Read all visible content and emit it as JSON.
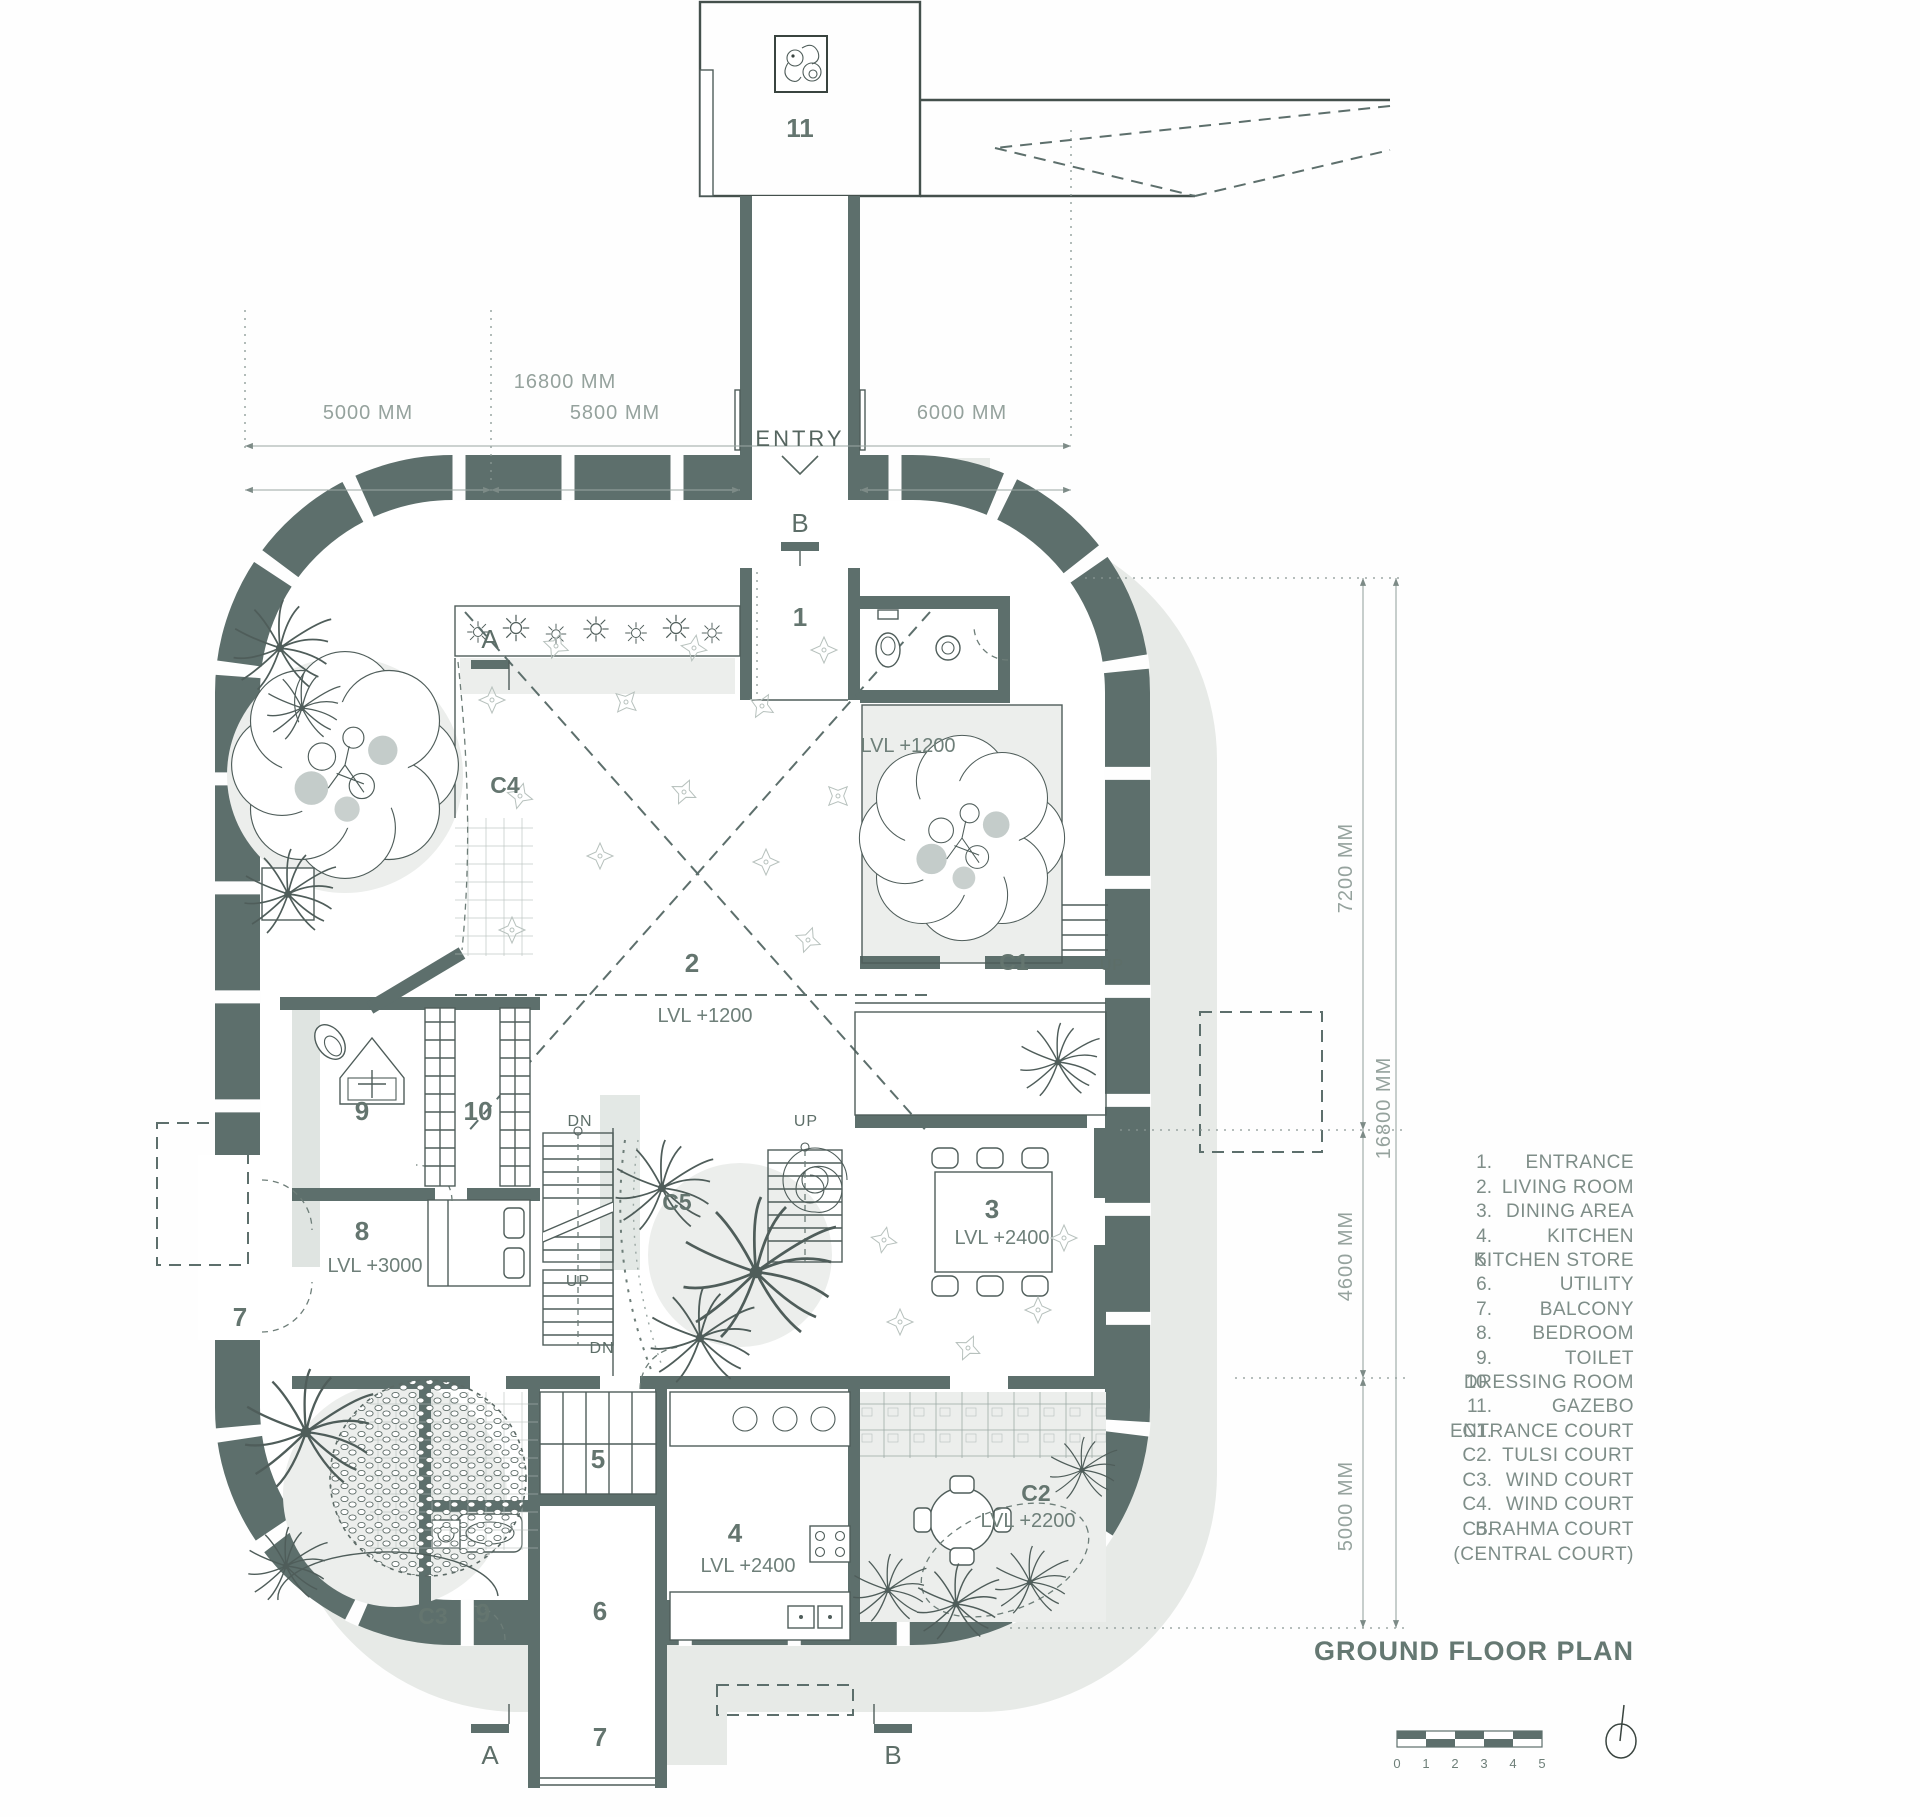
{
  "title": "GROUND FLOOR PLAN",
  "plan": {
    "entry_label": "ENTRY",
    "sections": {
      "a": "A",
      "b": "B"
    },
    "rooms": {
      "n1": "1",
      "n2": "2",
      "n3": "3",
      "n4": "4",
      "n5": "5",
      "n6": "6",
      "n7": "7",
      "n8": "8",
      "n9": "9",
      "n10": "10",
      "n11": "11"
    },
    "courts": {
      "c1": "C1",
      "c2": "C2",
      "c3": "C3",
      "c4": "C4",
      "c5": "C5"
    },
    "levels": {
      "l1200": "LVL +1200",
      "l2400": "LVL +2400",
      "l3000": "LVL +3000",
      "l2200": "LVL +2200"
    },
    "stairs": {
      "up": "UP",
      "dn": "DN"
    }
  },
  "dimensions": {
    "top_total": "16800 MM",
    "top_seg1": "5000 MM",
    "top_seg2": "5800 MM",
    "top_seg3": "6000 MM",
    "right_total": "16800 MM",
    "right_seg1": "7200 MM",
    "right_seg2": "4600 MM",
    "right_seg3": "5000 MM"
  },
  "legend": {
    "items": [
      {
        "num": "1.",
        "label": "ENTRANCE"
      },
      {
        "num": "2.",
        "label": "LIVING ROOM"
      },
      {
        "num": "3.",
        "label": "DINING AREA"
      },
      {
        "num": "4.",
        "label": "KITCHEN"
      },
      {
        "num": "5.",
        "label": "KITCHEN STORE"
      },
      {
        "num": "6.",
        "label": "UTILITY"
      },
      {
        "num": "7.",
        "label": "BALCONY"
      },
      {
        "num": "8.",
        "label": "BEDROOM"
      },
      {
        "num": "9.",
        "label": "TOILET"
      },
      {
        "num": "10.",
        "label": "DRESSING ROOM"
      },
      {
        "num": "11.",
        "label": "GAZEBO"
      },
      {
        "num": "C1.",
        "label": "ENTRANCE  COURT"
      },
      {
        "num": "C2.",
        "label": "TULSI COURT"
      },
      {
        "num": "C3.",
        "label": "WIND COURT"
      },
      {
        "num": "C4.",
        "label": "WIND COURT"
      },
      {
        "num": "C5.",
        "label": "BRAHMA COURT"
      }
    ],
    "note": "(CENTRAL COURT)"
  },
  "scalebar": {
    "ticks": [
      "0",
      "1",
      "2",
      "3",
      "4",
      "5"
    ]
  },
  "colors": {
    "wall": "#5d6f6c",
    "line": "#4f5d5a",
    "text": "#76857f",
    "shadow": "#e7eae7"
  }
}
